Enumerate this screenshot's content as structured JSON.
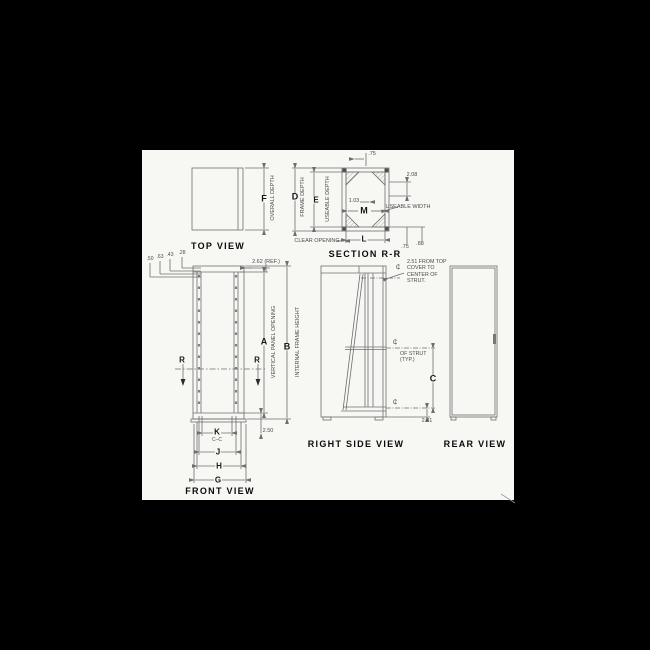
{
  "colors": {
    "background": "#000000",
    "sheet": "#f7f7f4",
    "line": "#6e6e6e",
    "ink": "#161616"
  },
  "views": {
    "top": {
      "title": "TOP VIEW",
      "dim_f": "F",
      "overall_depth": "OVERALL DEPTH"
    },
    "section": {
      "title": "SECTION R-R",
      "dim_d": "D",
      "frame_depth": "FRAME DEPTH",
      "dim_e": "E",
      "useable_depth": "USEABLE DEPTH",
      "dim_m": "M",
      "dim_l": "L",
      "useable_width": "USEABLE WIDTH",
      "clear_opening": "CLEAR OPENING",
      "top_thickness": ".75",
      "gusset_offset": "1.03",
      "rear_offset": "2.08",
      "bottom_offset_a": ".75",
      "bottom_offset_b": ".88"
    },
    "front": {
      "title": "FRONT VIEW",
      "dim_a": "A",
      "vertical_panel_opening": "VERTICAL PANEL OPENING",
      "dim_b": "B",
      "internal_frame_height": "INTERNAL FRAME HEIGHT",
      "dim_g": "G",
      "dim_h": "H",
      "dim_j": "J",
      "dim_k": "K",
      "k_note": "C–C",
      "section_marker": "R",
      "offsets": [
        ".50",
        ".63",
        ".43",
        ".28"
      ],
      "top_ref": "2.62 (REF.)",
      "bottom_ref": "2.50"
    },
    "side": {
      "title": "RIGHT SIDE VIEW",
      "dim_c": "C",
      "cl": "₵",
      "note": [
        "2.51 FROM TOP",
        "COVER TO",
        "CENTER OF",
        "STRUT."
      ],
      "strut_note": [
        "OF STRUT",
        "(TYP.)"
      ],
      "bottom_ref": "2.41"
    },
    "rear": {
      "title": "REAR VIEW"
    }
  }
}
